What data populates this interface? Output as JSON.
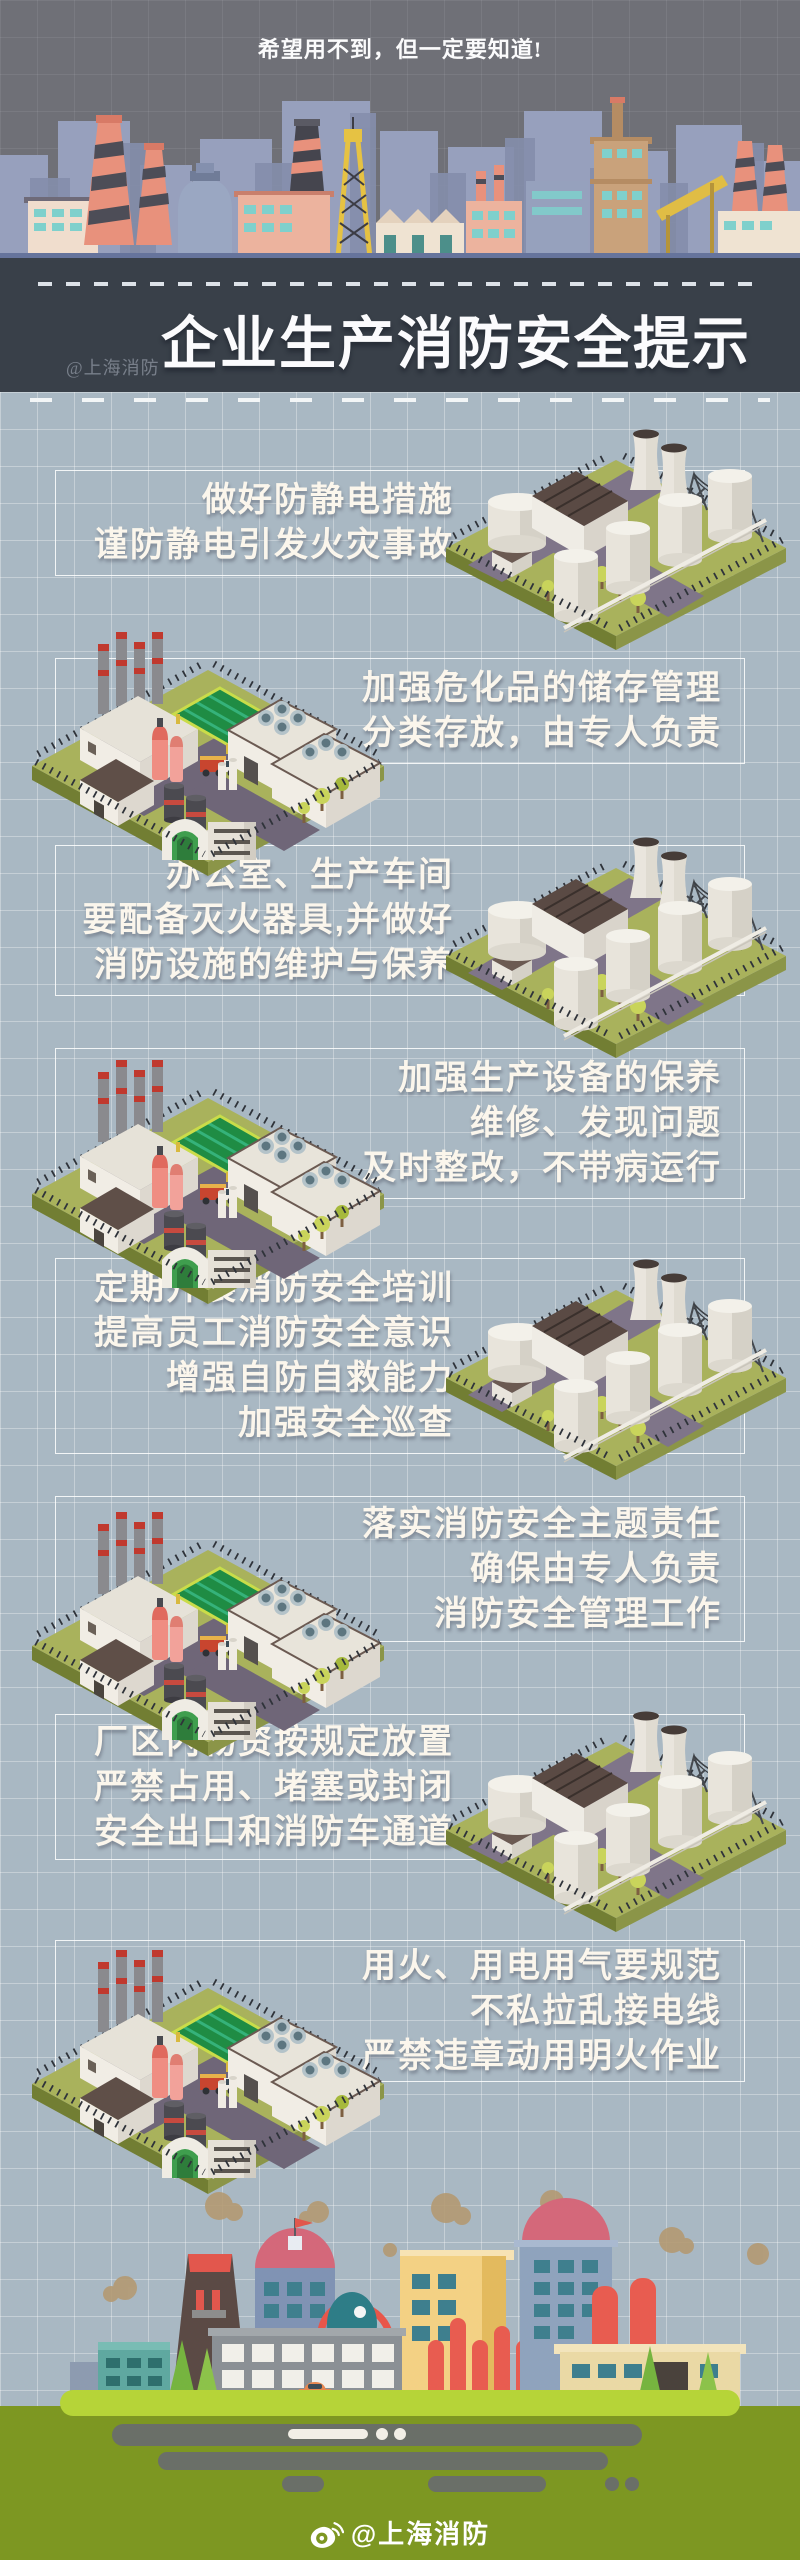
{
  "poster": {
    "tagline": "希望用不到，但一定要知道!",
    "title": "企业生产消防安全提示",
    "watermark": "@上海消防",
    "credit": "@上海消防"
  },
  "tips": [
    {
      "id": 1,
      "layout": "text-left",
      "illustration": "storage-tank-plant",
      "lines": [
        "做好防静电措施",
        "谨防静电引发火灾事故"
      ]
    },
    {
      "id": 2,
      "layout": "text-right",
      "illustration": "factory-complex",
      "lines": [
        "加强危化品的储存管理",
        "分类存放，由专人负责"
      ]
    },
    {
      "id": 3,
      "layout": "text-left",
      "illustration": "storage-tank-plant",
      "lines": [
        "办公室、生产车间",
        "要配备灭火器具,并做好",
        "消防设施的维护与保养"
      ]
    },
    {
      "id": 4,
      "layout": "text-right",
      "illustration": "factory-complex",
      "lines": [
        "加强生产设备的保养",
        "维修、发现问题",
        "及时整改，不带病运行"
      ]
    },
    {
      "id": 5,
      "layout": "text-left",
      "illustration": "storage-tank-plant",
      "lines": [
        "定期开展消防安全培训",
        "提高员工消防安全意识",
        "增强自防自救能力",
        "加强安全巡查"
      ]
    },
    {
      "id": 6,
      "layout": "text-right",
      "illustration": "factory-complex",
      "lines": [
        "落实消防安全主题责任",
        "确保由专人负责",
        "消防安全管理工作"
      ]
    },
    {
      "id": 7,
      "layout": "text-left",
      "illustration": "storage-tank-plant",
      "lines": [
        "厂区内物资按规定放置",
        "严禁占用、堵塞或封闭",
        "安全出口和消防车通道"
      ]
    },
    {
      "id": 8,
      "layout": "text-right",
      "illustration": "factory-complex",
      "lines": [
        "用火、用电用气要规范",
        "不私拉乱接电线",
        "严禁违章动用明火作业"
      ]
    }
  ],
  "colors": {
    "hero_background": "#6f7077",
    "band_background": "#394049",
    "content_background": "#a9b8c3",
    "tip_text": "#fbf6ec",
    "tip_box_border": "#ffffff",
    "accent_red": "#e2574d",
    "isometric_green": "#a9b25c",
    "footer_green": "#7d9722",
    "platform_lime": "#b6d438"
  }
}
